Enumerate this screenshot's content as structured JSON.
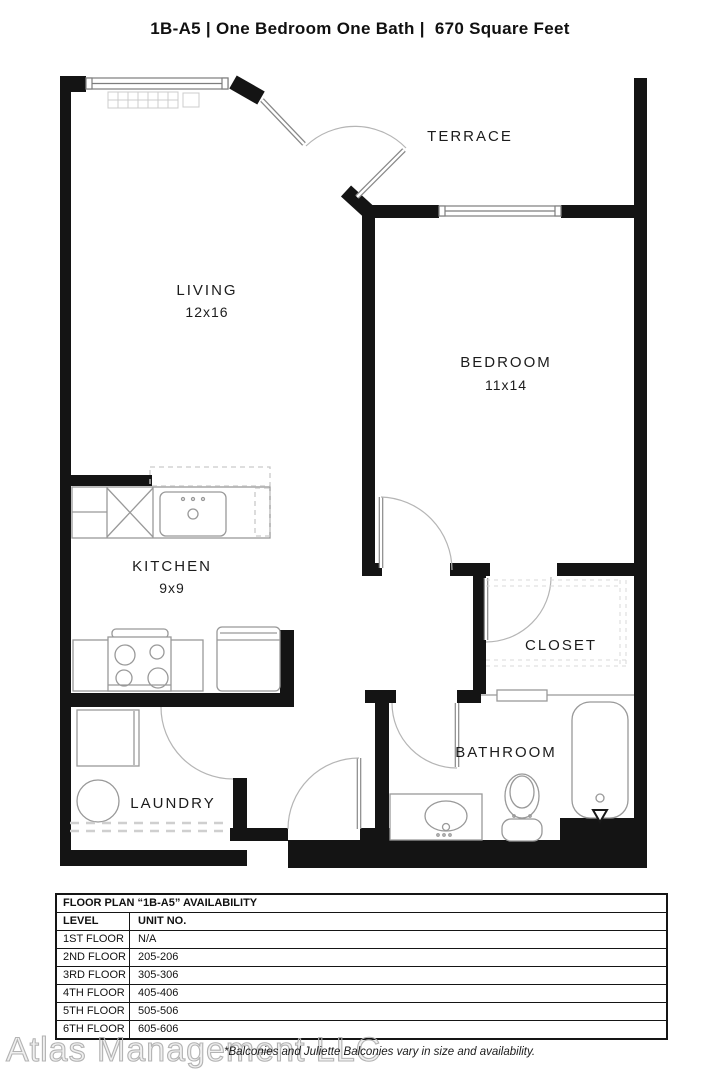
{
  "page": {
    "title": "1B-A5 | One Bedroom One Bath |  670 Square Feet"
  },
  "rooms": {
    "terrace": {
      "label": "TERRACE"
    },
    "living": {
      "label": "LIVING",
      "dimensions": "12x16"
    },
    "bedroom": {
      "label": "BEDROOM",
      "dimensions": "11x14"
    },
    "kitchen": {
      "label": "KITCHEN",
      "dimensions": "9x9"
    },
    "closet": {
      "label": "CLOSET"
    },
    "laundry": {
      "label": "LAUNDRY"
    },
    "bathroom": {
      "label": "BATHROOM"
    }
  },
  "availability_table": {
    "title": "FLOOR PLAN “1B-A5” AVAILABILITY",
    "columns": [
      "LEVEL",
      "UNIT NO."
    ],
    "rows": [
      {
        "level": "1ST FLOOR",
        "unit": "N/A"
      },
      {
        "level": "2ND FLOOR",
        "unit": "205-206"
      },
      {
        "level": "3RD FLOOR",
        "unit": "305-306"
      },
      {
        "level": "4TH FLOOR",
        "unit": "405-406"
      },
      {
        "level": "5TH FLOOR",
        "unit": "505-506"
      },
      {
        "level": "6TH FLOOR",
        "unit": "605-606"
      }
    ]
  },
  "footer": {
    "watermark": "Atlas Management LLC",
    "disclaimer": "*Balconies and Juliette Balconies vary in size and availability."
  },
  "colors": {
    "wall": "#141414",
    "fixture_line": "#999999",
    "dashed_line": "#c9c9c9",
    "label_text": "#1c1c1c"
  }
}
